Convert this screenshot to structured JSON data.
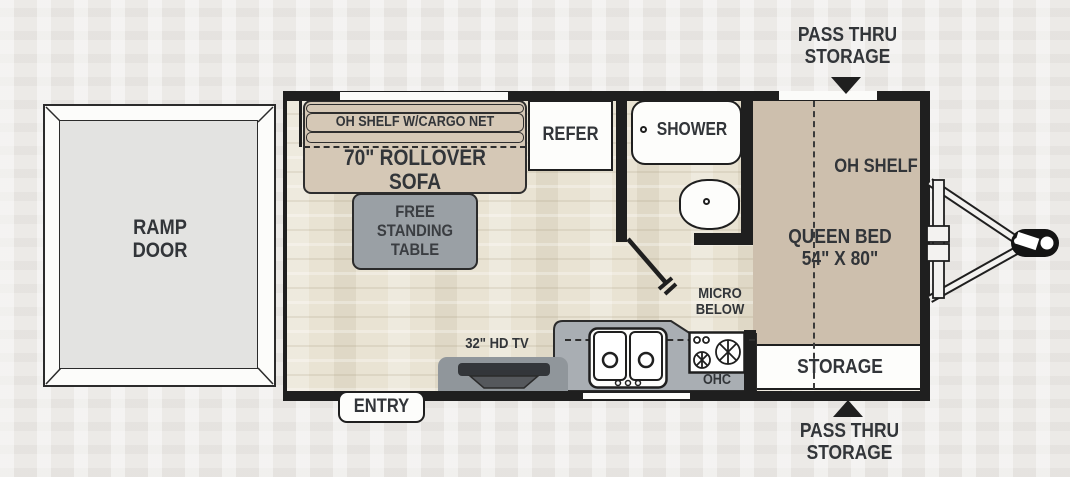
{
  "plan": {
    "ramp_door": "RAMP\nDOOR",
    "cargo_shelf": "OH SHELF W/CARGO NET",
    "sofa": "70\" ROLLOVER SOFA",
    "table": "FREE\nSTANDING\nTABLE",
    "refer": "REFER",
    "shower": "SHOWER",
    "oh_shelf": "OH SHELF",
    "queen_bed": "QUEEN BED\n54\" X 80\"",
    "storage": "STORAGE",
    "micro": "MICRO\nBELOW",
    "ohc": "OHC",
    "tv": "32\" HD TV",
    "entry": "ENTRY",
    "pass_thru_top": "PASS THRU\nSTORAGE",
    "pass_thru_bottom": "PASS THRU\nSTORAGE"
  },
  "colors": {
    "wall": "#1f1f1f",
    "furniture_tan": "#d5c8b6",
    "bed_tan": "#cdbfad",
    "table_gray": "#9aa0a5",
    "counter_gray": "#a9aeb3",
    "floor": "#e9e3d3",
    "background": "#eceae7",
    "text": "#323539"
  }
}
